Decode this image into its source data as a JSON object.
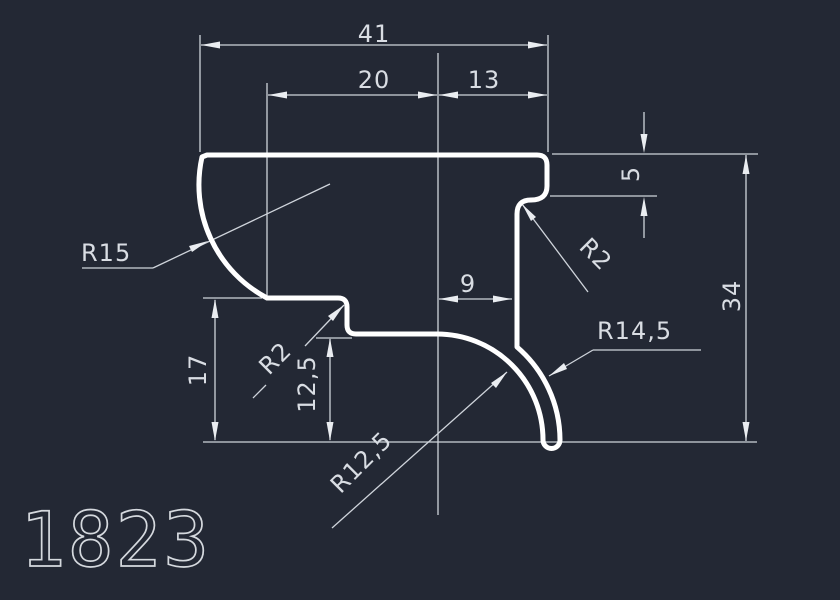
{
  "app": {
    "type": "cad-profile-drawing",
    "background_color": "#232834"
  },
  "colors": {
    "profile_stroke": "#ffffff",
    "dimension_lines": "#cfd4db",
    "dimension_text": "#d9dde3",
    "part_number_text": "#d5d9de"
  },
  "part": {
    "number": "1823"
  },
  "dimensions": {
    "total_width": "41",
    "left_width": "20",
    "right_width": "13",
    "lip_height": "5",
    "total_height": "34",
    "wall_inset": "9",
    "left_height": "17",
    "inner_height": "12,5"
  },
  "radii": {
    "left_arc": "R15",
    "left_step_fillet": "R2",
    "lip_fillet": "R2",
    "outer_wall": "R14,5",
    "inner_wall": "R12,5"
  }
}
